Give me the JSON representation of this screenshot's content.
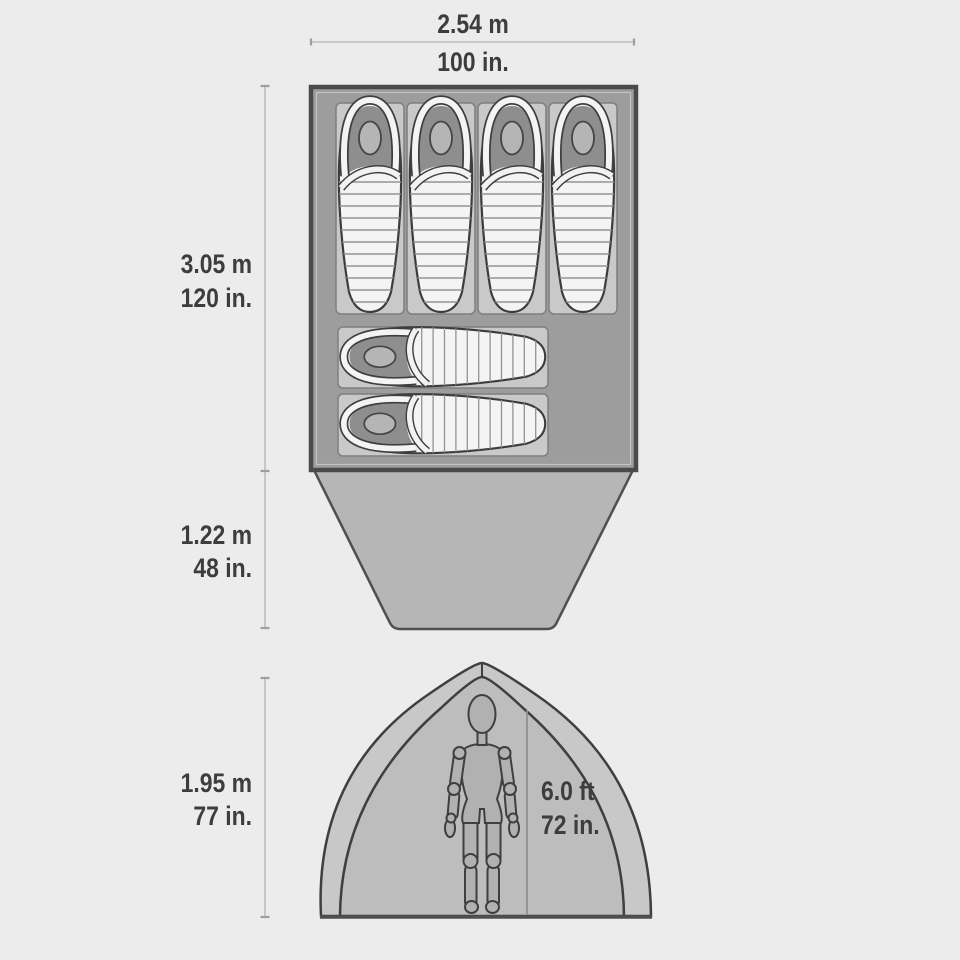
{
  "diagram": {
    "type": "tent-spec-diagram",
    "top_view": {
      "width": {
        "metric": "2.54 m",
        "imperial": "100 in."
      },
      "floor_length": {
        "metric": "3.05 m",
        "imperial": "120 in."
      },
      "vestibule_depth": {
        "metric": "1.22 m",
        "imperial": "48 in."
      },
      "sleeping_bags": {
        "vertical_count": 4,
        "horizontal_count": 2
      }
    },
    "front_view": {
      "peak_height": {
        "metric": "1.95 m",
        "imperial": "77 in."
      },
      "standing_clearance": {
        "feet": "6.0 ft",
        "imperial": "72 in."
      }
    },
    "colors": {
      "background": "#ececec",
      "tent_floor": "#9d9d9d",
      "outline": "#3f3f3f",
      "pad": "#c9c9c9",
      "sleeping_bag": "#f4f4f4",
      "vestibule": "#b6b6b6",
      "dome_fill": "#bdbdbd",
      "fly_fill": "#c8c8c8",
      "mannequin": "#b1b1b1",
      "dimension_line": "#bdbdbd",
      "text": "#3d3d3d"
    }
  }
}
